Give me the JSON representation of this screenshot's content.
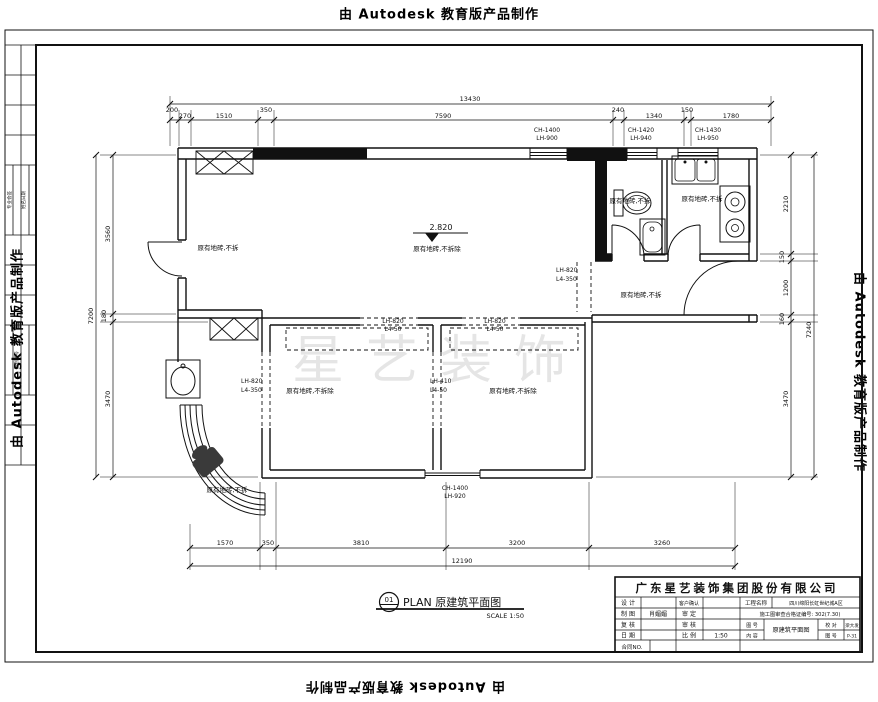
{
  "credits": {
    "top": "由 Autodesk 教育版产品制作",
    "bottom": "由 Autodesk 教育版产品制作",
    "left": "由 Autodesk 教育版产品制作",
    "right": "由 Autodesk 教育版产品制作"
  },
  "watermark": "星艺装饰",
  "dims": {
    "top_total": "13430",
    "top_segments": [
      "200",
      "270",
      "1510",
      "350",
      "7590",
      "240",
      "1340",
      "150",
      "1780"
    ],
    "bottom_segments": [
      "1570",
      "350",
      "3810",
      "3200",
      "3260"
    ],
    "bottom_total": "12190",
    "left_total": "7200",
    "left_segments": [
      "3560",
      "180",
      "3470"
    ],
    "right_segments": [
      "2210",
      "150",
      "1200",
      "160",
      "3470"
    ],
    "right_total": "7240"
  },
  "windows": {
    "top1_l1": "CH-1400",
    "top1_l2": "LH-900",
    "top2_l1": "CH-1420",
    "top2_l2": "LH-940",
    "top3_l1": "CH-1430",
    "top3_l2": "LH-950",
    "bottom_l1": "CH-1400",
    "bottom_l2": "LH-920",
    "left_l1": "LH-820",
    "left_l2": "L4-350",
    "mid_l1": "LH-410",
    "mid_l2": "L4-50",
    "hall_l1": "LH-820",
    "hall_l2": "L4-350",
    "bed1_l1": "LH-820",
    "bed1_l2": "L4-50",
    "bed2_l1": "LH-820",
    "bed2_l2": "L4-50"
  },
  "labels": {
    "elevation": "2.820",
    "living_left": "原有地砖,不拆",
    "living_center": "原有地砖,不拆除",
    "bathroom": "原有地砖,不拆",
    "kitchen": "原有地砖,不拆",
    "hallway": "原有地砖,不拆",
    "bedroom1": "原有地砖,不拆除",
    "bedroom2": "原有地砖,不拆除",
    "balcony": "原有地砖,不拆"
  },
  "plan_title": {
    "number": "01",
    "label": "PLAN 原建筑平面图",
    "scale": "SCALE 1:50"
  },
  "title_block": {
    "company": "广东星艺装饰集团股份有限公司",
    "r1c1": "设 计",
    "r1c3": "客户确认",
    "r2c1": "制 图",
    "r2c2": "肖媚媚",
    "r2c3": "审 定",
    "r3c1": "复 核",
    "r3c3": "审 核",
    "r4c1": "日 期",
    "r4c3": "比 例",
    "r4c4": "1:50",
    "r5c1": "合同NO.",
    "project_label": "工程名称",
    "project_value": "四川绵阳长虹世纪城A区",
    "permit_text": "施工图审查合格证编号: 302(7.30)",
    "sheet_label": "图 号",
    "content_label": "内 容",
    "drawing_name": "原建筑平面图",
    "proof_label": "校 对",
    "proof_value": "梁大发",
    "no_label": "图 号",
    "no_value": "P-31"
  },
  "frame_strip": {
    "col1": "专业会签",
    "col2": "姓名日期",
    "col3": "图别图号"
  }
}
